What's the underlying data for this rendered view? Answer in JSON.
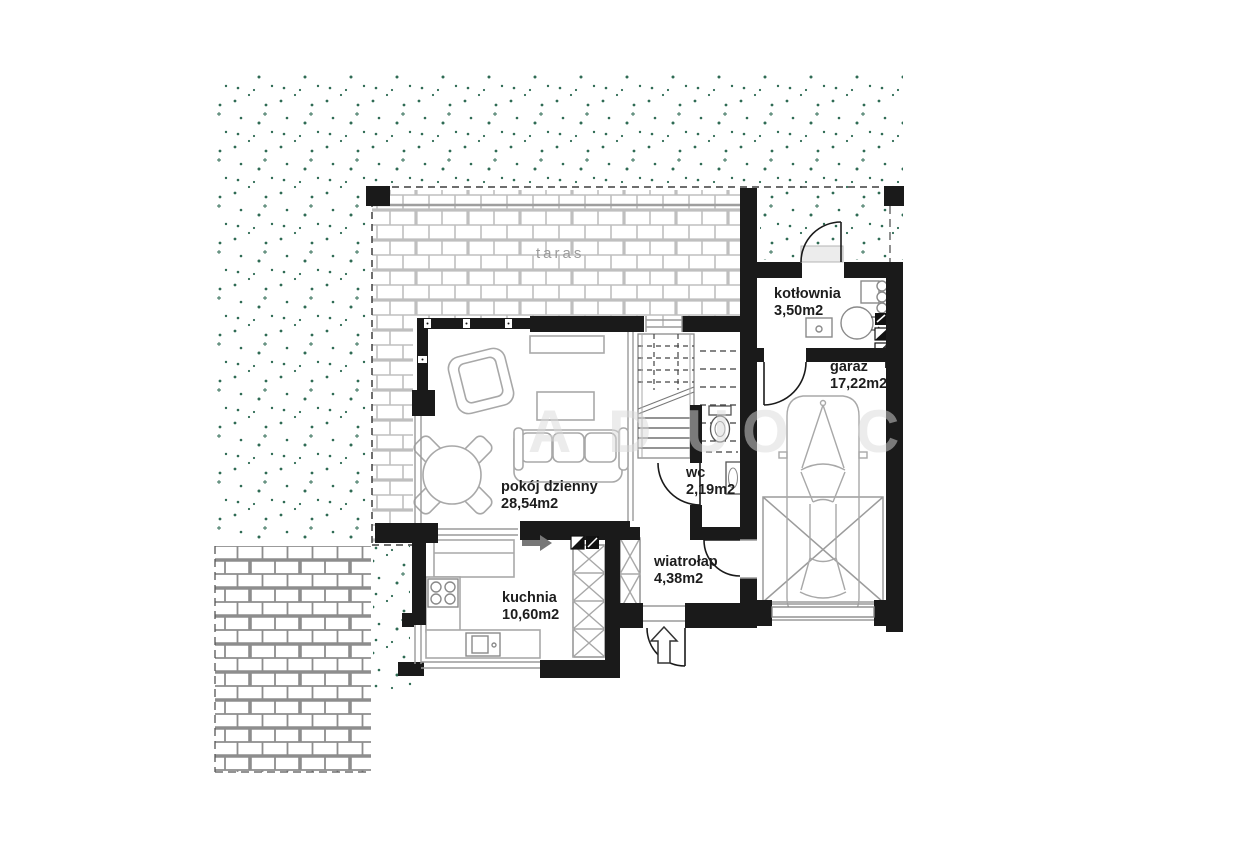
{
  "plan": {
    "terrace": {
      "label": "taras"
    },
    "rooms": [
      {
        "id": "kotlownia",
        "name": "kotłownia",
        "area": "3,50m2"
      },
      {
        "id": "garaz",
        "name": "garaż",
        "area": "17,22m2"
      },
      {
        "id": "pokoj-dzienny",
        "name": "pokój dzienny",
        "area": "28,54m2"
      },
      {
        "id": "wc",
        "name": "wc",
        "area": "2,19m2"
      },
      {
        "id": "wiatrolap",
        "name": "wiatrołap",
        "area": "4,38m2"
      },
      {
        "id": "kuchnia",
        "name": "kuchnia",
        "area": "10,60m2"
      }
    ],
    "watermark": {
      "letters": [
        "A",
        "D",
        "U",
        "O",
        "C"
      ]
    },
    "colors": {
      "wall": "#1a1a1a",
      "vegetation_dot": "#2f6b54",
      "terrace_brick_line": "#bfbfbf",
      "patio_brick_line": "#8d8d8d",
      "furniture_outline": "#a8a8a8",
      "label_text": "#1d1d1d",
      "terrace_label_text": "#9b9b9b",
      "watermark_text": "#dadada"
    }
  }
}
